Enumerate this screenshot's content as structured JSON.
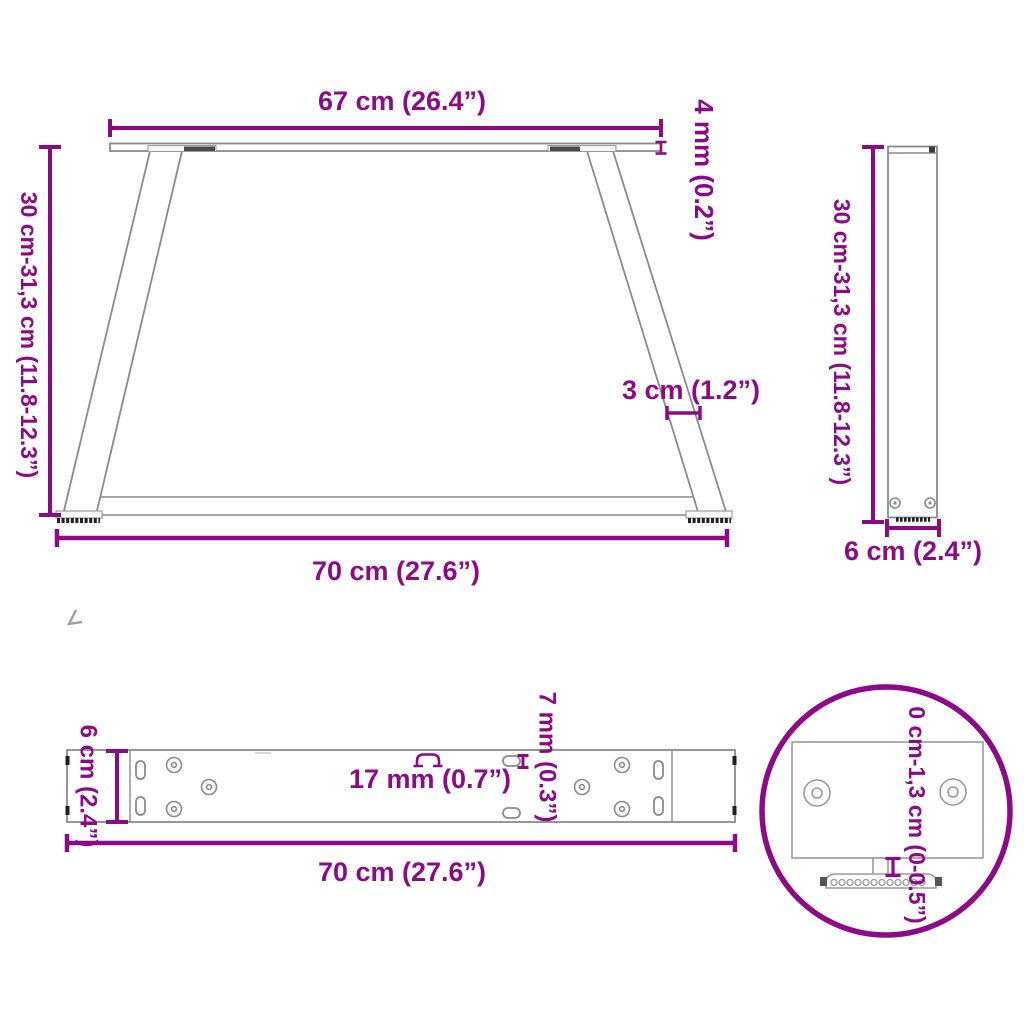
{
  "drawing_title": "table-leg-dimension-diagram",
  "colors": {
    "accent_magenta": "#8C0A87",
    "structure_gray": "#8a8a8a",
    "dark_detail": "#1f1f1f"
  },
  "views": {
    "front": {
      "top_width_label": "67 cm (26.4”)",
      "plate_thickness_label": "4 mm (0.2”)",
      "height_label": "30 cm-31,3 cm (11.8-12.3”)",
      "leg_width_label": "3 cm (1.2”)",
      "bottom_width_label": "70 cm (27.6”)"
    },
    "side": {
      "height_label": "30 cm-31,3 cm (11.8-12.3”)",
      "depth_label": "6 cm (2.4”)"
    },
    "plate_top": {
      "depth_label": "6 cm (2.4”)",
      "slot_length_label": "17 mm (0.7”)",
      "slot_width_label": "7 mm (0.3”)",
      "length_label": "70 cm (27.6”)"
    },
    "detail": {
      "adjust_range_label": "0 cm-1,3 cm (0-0.5”)"
    }
  }
}
